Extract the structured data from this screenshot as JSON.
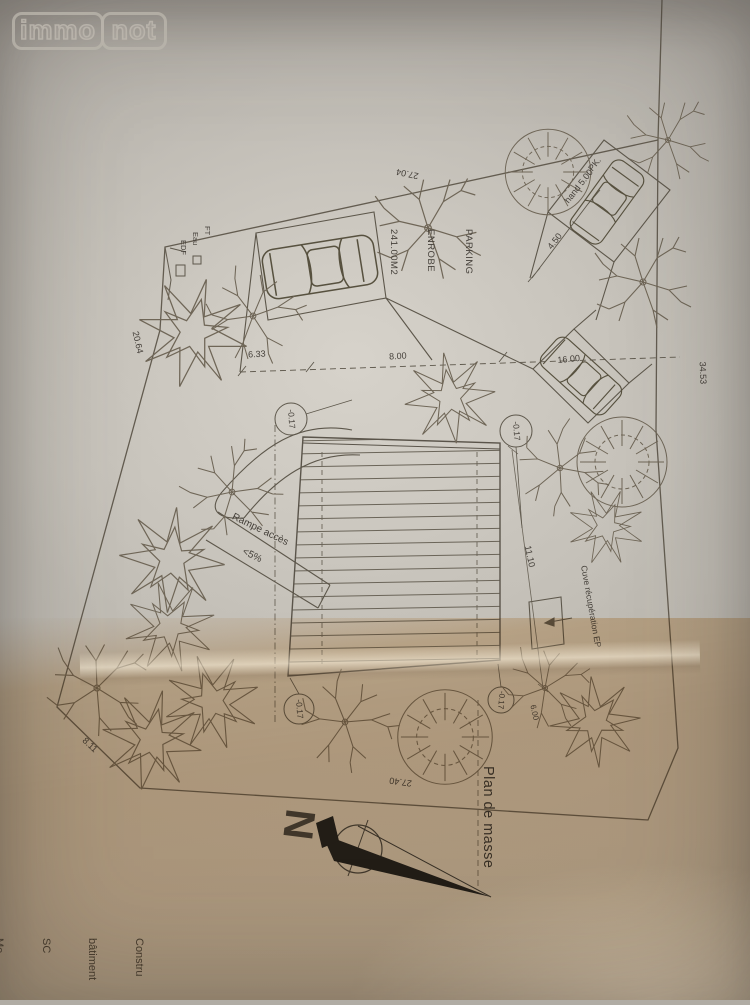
{
  "watermark": {
    "immo": "immo",
    "not": "not"
  },
  "plan": {
    "title": "Plan de masse",
    "north_letter": "N",
    "level_marker": "-0.17",
    "parking_label": {
      "line1": "PARKING",
      "line2": "ENROBE",
      "line3": "241.00M2"
    },
    "ramp": {
      "line1": "Rampe accès",
      "line2": "<5%"
    },
    "cuve_label": "Cuve récupération EP",
    "pk": {
      "line1": "PK.",
      "line2": "hand 5.00"
    },
    "utilities": {
      "ft": "FT",
      "eau": "Eau",
      "edf": "EDF"
    },
    "dims": {
      "top": "27.04",
      "left": "20.64",
      "right": "34.53",
      "bottom": "27.40",
      "bottom_left": "8.11",
      "stall_width": "4.50",
      "front_left": "6.33",
      "front_mid": "8.00",
      "stall_right": "16.00",
      "side_right": "11.10",
      "corner_right": "6.00"
    }
  },
  "footer_block": {
    "lines": [
      "Constru",
      "bâtiment",
      "SC",
      "Me",
      "06",
      "Ec",
      "Architecte"
    ]
  }
}
